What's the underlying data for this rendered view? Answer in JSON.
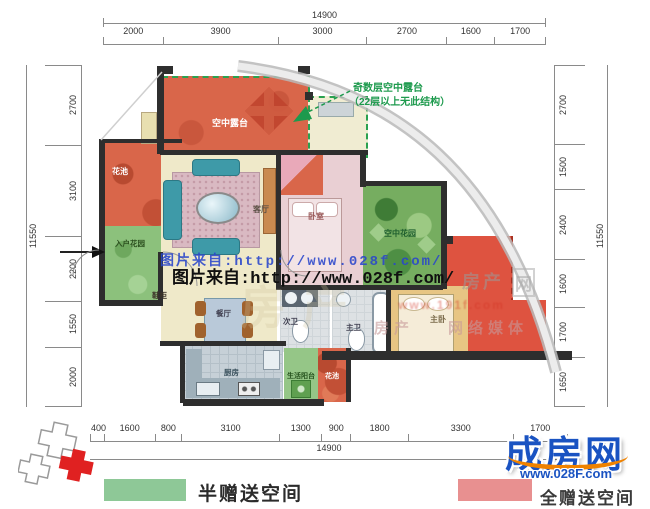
{
  "dims": {
    "top": {
      "total": "14900",
      "segments": [
        "2000",
        "3900",
        "3000",
        "2700",
        "1600",
        "1700"
      ]
    },
    "bottom": {
      "total": "14900",
      "segments": [
        "400",
        "1600",
        "800",
        "3100",
        "1300",
        "900",
        "1800",
        "3300",
        "1700"
      ]
    },
    "left": {
      "total": "11550",
      "segments": [
        "2700",
        "3100",
        "2200",
        "1550",
        "2000"
      ]
    },
    "right": {
      "total": "11550",
      "segments": [
        "2700",
        "1500",
        "2400",
        "1600",
        "1700",
        "1650"
      ]
    }
  },
  "rooms": {
    "sky_terrace": "空中露台",
    "flower_pond_left": "花池",
    "entry_garden": "入户花园",
    "shoe_cabinet": "鞋柜",
    "living_room": "客厅",
    "bedroom": "卧室",
    "sky_garden": "空中花园",
    "dining_room": "餐厅",
    "guest_bathroom": "次卫",
    "master_bathroom": "主卫",
    "master_bedroom": "主卧",
    "kitchen": "厨房",
    "utility_balcony": "生活阳台",
    "flower_pond_bottom": "花池"
  },
  "annotation": {
    "line1": "奇数层空中露台",
    "line2": "（22层以上无此结构）"
  },
  "watermarks": {
    "photo_credit_blue": "图片来自:http://www.028f.com/",
    "photo_credit_black": "图片来自:http://www.028f.com/",
    "faint_text_1": "房产",
    "faint_text_2": "网",
    "faint_text_3": "房产",
    "faint_text_4": "网络媒体",
    "faint_url": "www.191f.com"
  },
  "legend": {
    "half_gift": {
      "label": "半赠送空间",
      "color": "#8ec897"
    },
    "full_gift": {
      "label": "全赠送空间",
      "color": "#e89090"
    }
  },
  "logo": {
    "name": "成房网",
    "url": "www.028F.com"
  },
  "colors": {
    "terrace_red": "#d9664a",
    "bright_red_terrace": "#de5340",
    "gift_green": "#8cc17c",
    "wall": "#2e2e2e",
    "annotation_green": "#1d9a4d",
    "watermark_blue": "#2946cc",
    "logo_blue": "#1a53c2",
    "logo_orange": "#ef8200"
  }
}
